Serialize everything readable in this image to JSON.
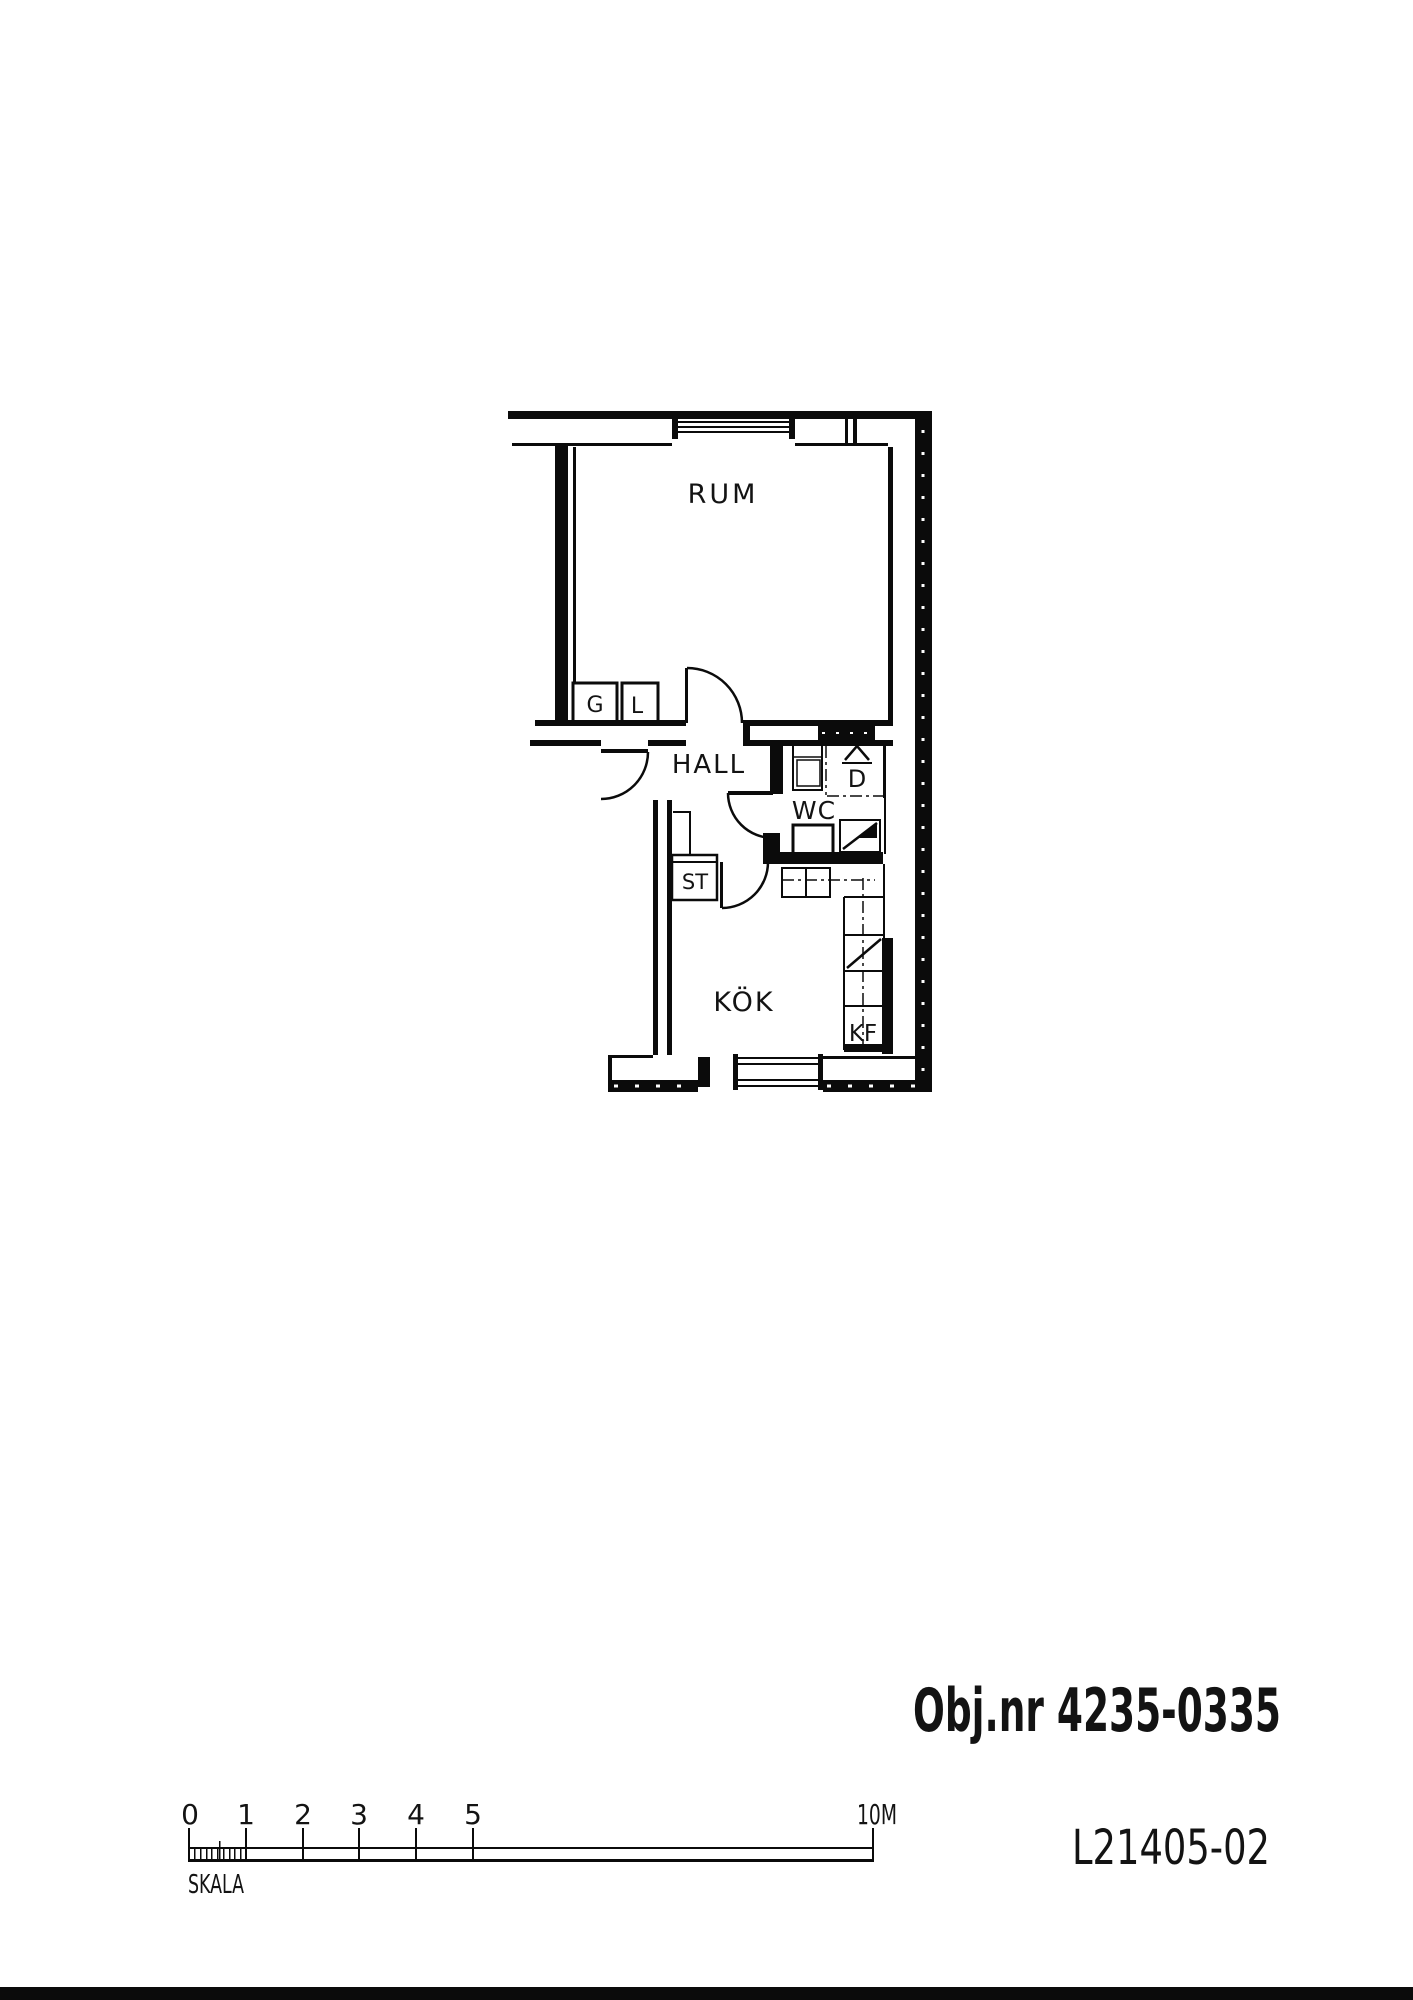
{
  "plan": {
    "room_labels": {
      "rum": "RUM",
      "hall": "HALL",
      "wc": "WC",
      "kok": "KÖK"
    },
    "fixture_labels": {
      "g": "G",
      "l": "L",
      "st": "ST",
      "d": "D",
      "kf": "KF"
    }
  },
  "annotations": {
    "object_number": "Obj.nr 4235-0335",
    "drawing_number": "L21405-02"
  },
  "scale_bar": {
    "label": "SKALA",
    "tick_labels": [
      "0",
      "1",
      "2",
      "3",
      "4",
      "5"
    ],
    "end_label": "10M"
  }
}
